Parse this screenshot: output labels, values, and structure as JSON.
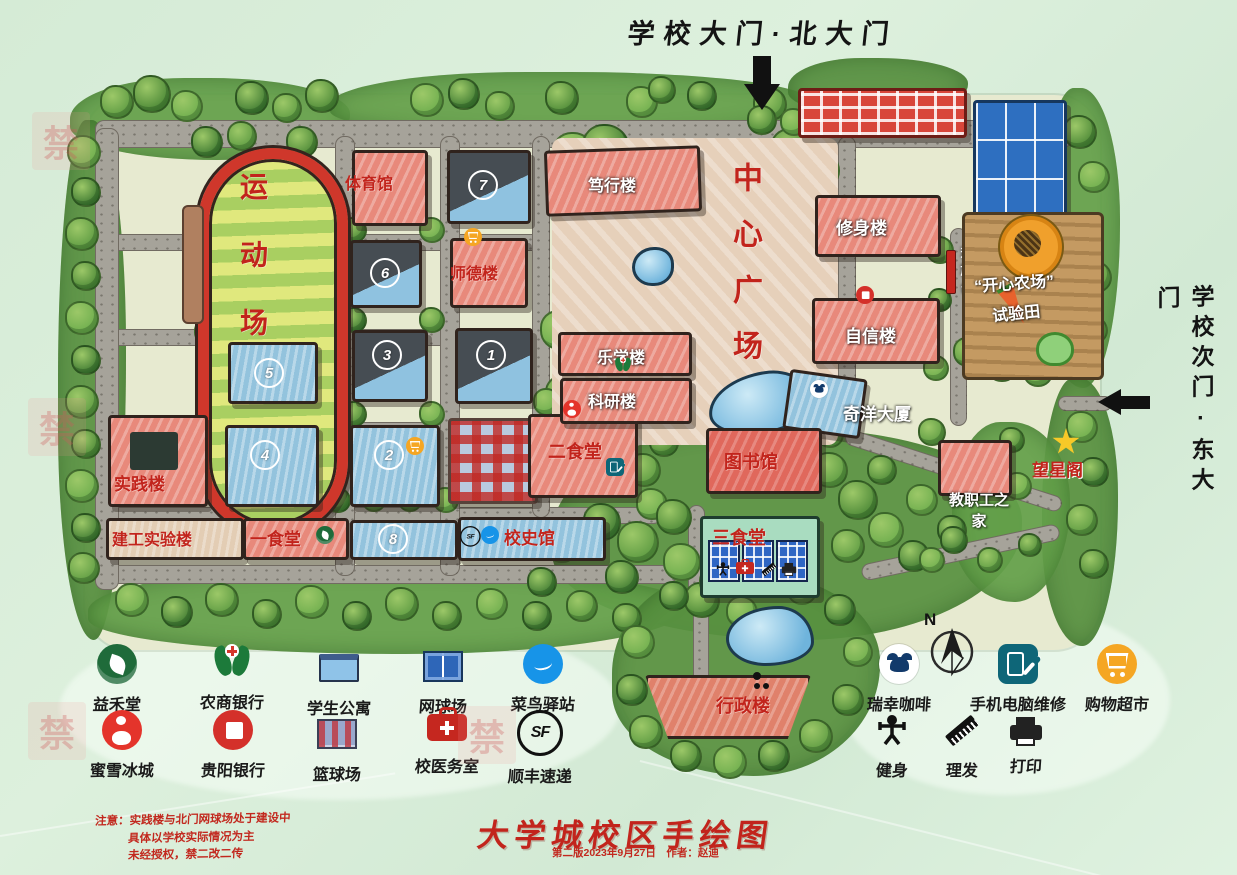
{
  "gates": {
    "north_label": "学校大门·北大门",
    "east_label": "学校次门·东大门"
  },
  "plaza": {
    "label": "中心广场"
  },
  "buildings": {
    "sports_field": "运动场",
    "gymnasium": "体育馆",
    "shide": "师德楼",
    "duxing": "笃行楼",
    "xiushen": "修身楼",
    "flag_platform": "升旗台",
    "happy_farm": "“开心农场”",
    "test_field": "试验田",
    "zixin": "自信楼",
    "lexue": "乐学楼",
    "keyan": "科研楼",
    "qiyang": "奇洋大厦",
    "shijian": "实践楼",
    "canteen2": "二食堂",
    "library": "图书馆",
    "wangxing": "望星阁",
    "faculty_home": "教职工之家",
    "jiangong": "建工实验楼",
    "canteen1": "一食堂",
    "history_hall": "校史馆",
    "canteen3": "三食堂",
    "admin": "行政楼"
  },
  "numbers": {
    "n1": "1",
    "n2": "2",
    "n3": "3",
    "n4": "4",
    "n5": "5",
    "n6": "6",
    "n7": "7",
    "n8": "8"
  },
  "legend": {
    "compass": "N",
    "sf_text": "SF",
    "row1": [
      {
        "icon": "yihetang-logo",
        "label": "益禾堂"
      },
      {
        "icon": "rural-commercial-bank-logo",
        "label": "农商银行"
      },
      {
        "icon": "student-apartment",
        "label": "学生公寓"
      },
      {
        "icon": "tennis-court",
        "label": "网球场"
      },
      {
        "icon": "cainiao-station-logo",
        "label": "菜鸟驿站"
      },
      {
        "icon": "luckin-coffee-logo",
        "label": "瑞幸咖啡"
      },
      {
        "icon": "phone-computer-repair",
        "label": "手机电脑维修"
      },
      {
        "icon": "shopping-cart",
        "label": "购物超市"
      }
    ],
    "row2": [
      {
        "icon": "mixue-logo",
        "label": "蜜雪冰城"
      },
      {
        "icon": "guiyang-bank-logo",
        "label": "贵阳银行"
      },
      {
        "icon": "basketball-court",
        "label": "篮球场"
      },
      {
        "icon": "first-aid-kit",
        "label": "校医务室"
      },
      {
        "icon": "sf-express-logo",
        "label": "顺丰速递"
      },
      {
        "icon": "fitness",
        "label": "健身"
      },
      {
        "icon": "haircut-comb",
        "label": "理发"
      },
      {
        "icon": "printer",
        "label": "打印"
      }
    ]
  },
  "footer": {
    "title": "大学城校区手绘图",
    "subtitle": "第二版2023年9月27日　作者：赵迪",
    "notes": [
      "注意：实践楼与北门网球场处于建设中",
      "具体以学校实际情况为主",
      "未经授权，禁二改二传"
    ]
  },
  "watermark": "禁",
  "colors": {
    "label_red": "#c2241c",
    "title_black": "#141414",
    "background_green": "#d9ecdb",
    "track_red": "#cf372b"
  }
}
